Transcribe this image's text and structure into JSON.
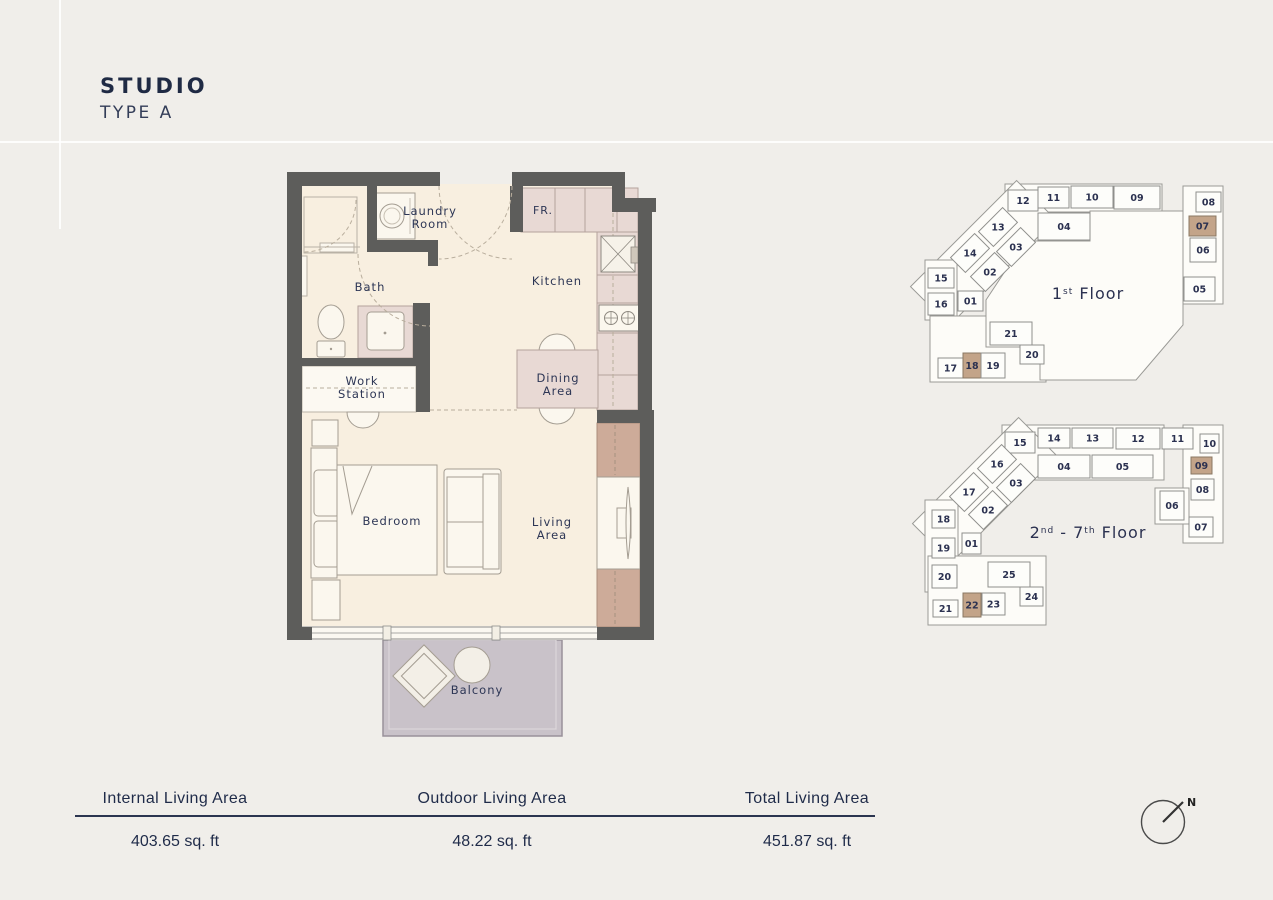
{
  "title": {
    "line1": "STUDIO",
    "line2": "TYPE A"
  },
  "floorplan": {
    "rooms": {
      "laundry": [
        "Laundry",
        "Room"
      ],
      "bath": "Bath",
      "kitchen": "Kitchen",
      "fridge": "FR.",
      "workstation": [
        "Work",
        "Station"
      ],
      "dining": [
        "Dining",
        "Area"
      ],
      "bedroom": "Bedroom",
      "living": [
        "Living",
        "Area"
      ],
      "balcony": "Balcony"
    },
    "colors": {
      "wall": "#5d5d5b",
      "floor": "#f8efe0",
      "counter": "#e8d9d4",
      "wardrobe": "#cdab99",
      "balcony": "#c9c2c9",
      "label": "#2d3655",
      "highlight": "#c3a489"
    }
  },
  "keyplans": [
    {
      "name": "keyplan-first-floor",
      "label_parts": [
        {
          "t": "1"
        },
        {
          "t": "st",
          "sup": true
        },
        {
          "t": " Floor"
        }
      ],
      "label_x": 1088,
      "label_y": 299,
      "blocks": [
        {
          "x": 1005,
          "y": 184,
          "w": 157,
          "h": 28
        },
        {
          "x": 1183,
          "y": 186,
          "w": 40,
          "h": 118
        },
        {
          "x": 908,
          "y": 225.5,
          "w": 150,
          "h": 55,
          "r": -45
        },
        {
          "x": 925,
          "y": 260,
          "w": 32,
          "h": 60
        },
        {
          "x": 930,
          "y": 316,
          "w": 116,
          "h": 66
        }
      ],
      "hall": "1025,241 1090,241 1090,211 1183,211 1183,325 1136,380 1040,380 1040,347 986,347 986,300",
      "units": [
        {
          "n": "12",
          "x": 1008,
          "y": 190,
          "w": 30,
          "h": 21
        },
        {
          "n": "11",
          "x": 1038,
          "y": 187,
          "w": 31,
          "h": 21
        },
        {
          "n": "10",
          "x": 1071,
          "y": 186,
          "w": 42,
          "h": 22
        },
        {
          "n": "09",
          "x": 1114,
          "y": 186,
          "w": 46,
          "h": 23
        },
        {
          "n": "04",
          "x": 1038,
          "y": 213,
          "w": 52,
          "h": 27
        },
        {
          "n": "08",
          "x": 1196,
          "y": 192,
          "w": 25,
          "h": 20
        },
        {
          "n": "07",
          "x": 1189,
          "y": 216,
          "w": 27,
          "h": 20,
          "hl": true
        },
        {
          "n": "06",
          "x": 1190,
          "y": 238,
          "w": 26,
          "h": 24
        },
        {
          "n": "05",
          "x": 1184,
          "y": 277,
          "w": 31,
          "h": 24
        },
        {
          "n": "13",
          "x": 981,
          "y": 216.5,
          "w": 34,
          "h": 21,
          "r": -45
        },
        {
          "n": "03",
          "x": 999,
          "y": 236.5,
          "w": 34,
          "h": 21,
          "r": -45
        },
        {
          "n": "14",
          "x": 953,
          "y": 242.5,
          "w": 34,
          "h": 21,
          "r": -45
        },
        {
          "n": "02",
          "x": 973,
          "y": 261.5,
          "w": 34,
          "h": 21,
          "r": -45
        },
        {
          "n": "15",
          "x": 928,
          "y": 268,
          "w": 26,
          "h": 20
        },
        {
          "n": "16",
          "x": 928,
          "y": 293,
          "w": 26,
          "h": 22
        },
        {
          "n": "01",
          "x": 958,
          "y": 291,
          "w": 25,
          "h": 20
        },
        {
          "n": "21",
          "x": 990,
          "y": 322,
          "w": 42,
          "h": 23
        },
        {
          "n": "20",
          "x": 1020,
          "y": 345,
          "w": 24,
          "h": 19
        },
        {
          "n": "17",
          "x": 938,
          "y": 358,
          "w": 25,
          "h": 20
        },
        {
          "n": "18",
          "x": 963,
          "y": 353,
          "w": 18,
          "h": 25,
          "hl": true
        },
        {
          "n": "19",
          "x": 981,
          "y": 353,
          "w": 24,
          "h": 25
        }
      ]
    },
    {
      "name": "keyplan-upper-floor",
      "label_parts": [
        {
          "t": "2"
        },
        {
          "t": "nd",
          "sup": true
        },
        {
          "t": " - 7"
        },
        {
          "t": "th",
          "sup": true
        },
        {
          "t": " Floor"
        }
      ],
      "label_x": 1088,
      "label_y": 538,
      "blocks": [
        {
          "x": 1002,
          "y": 425,
          "w": 162,
          "h": 55
        },
        {
          "x": 1183,
          "y": 425,
          "w": 40,
          "h": 118
        },
        {
          "x": 1155,
          "y": 488,
          "w": 34,
          "h": 36
        },
        {
          "x": 910,
          "y": 462.5,
          "w": 150,
          "h": 55,
          "r": -45
        },
        {
          "x": 925,
          "y": 500,
          "w": 33,
          "h": 92
        },
        {
          "x": 928,
          "y": 556,
          "w": 118,
          "h": 69
        }
      ],
      "units": [
        {
          "n": "15",
          "x": 1005,
          "y": 432,
          "w": 30,
          "h": 21
        },
        {
          "n": "14",
          "x": 1038,
          "y": 428,
          "w": 32,
          "h": 20
        },
        {
          "n": "13",
          "x": 1072,
          "y": 428,
          "w": 41,
          "h": 20
        },
        {
          "n": "12",
          "x": 1116,
          "y": 428,
          "w": 44,
          "h": 21
        },
        {
          "n": "11",
          "x": 1162,
          "y": 428,
          "w": 31,
          "h": 21
        },
        {
          "n": "10",
          "x": 1200,
          "y": 434,
          "w": 19,
          "h": 19
        },
        {
          "n": "04",
          "x": 1038,
          "y": 455,
          "w": 52,
          "h": 23
        },
        {
          "n": "05",
          "x": 1092,
          "y": 455,
          "w": 61,
          "h": 23
        },
        {
          "n": "09",
          "x": 1191,
          "y": 457,
          "w": 21,
          "h": 17,
          "hl": true
        },
        {
          "n": "08",
          "x": 1191,
          "y": 479,
          "w": 23,
          "h": 21
        },
        {
          "n": "06",
          "x": 1160,
          "y": 491,
          "w": 24,
          "h": 29
        },
        {
          "n": "07",
          "x": 1189,
          "y": 517,
          "w": 24,
          "h": 20
        },
        {
          "n": "16",
          "x": 980,
          "y": 453.5,
          "w": 34,
          "h": 21,
          "r": -45
        },
        {
          "n": "03",
          "x": 999,
          "y": 472.5,
          "w": 34,
          "h": 21,
          "r": -45
        },
        {
          "n": "17",
          "x": 952,
          "y": 481.5,
          "w": 34,
          "h": 21,
          "r": -45
        },
        {
          "n": "02",
          "x": 971,
          "y": 499.5,
          "w": 34,
          "h": 21,
          "r": -45
        },
        {
          "n": "18",
          "x": 932,
          "y": 510,
          "w": 23,
          "h": 18
        },
        {
          "n": "19",
          "x": 932,
          "y": 538,
          "w": 23,
          "h": 20
        },
        {
          "n": "01",
          "x": 962,
          "y": 533,
          "w": 19,
          "h": 21
        },
        {
          "n": "20",
          "x": 932,
          "y": 565,
          "w": 25,
          "h": 23
        },
        {
          "n": "25",
          "x": 988,
          "y": 562,
          "w": 42,
          "h": 25
        },
        {
          "n": "24",
          "x": 1020,
          "y": 587,
          "w": 23,
          "h": 19
        },
        {
          "n": "21",
          "x": 933,
          "y": 600,
          "w": 25,
          "h": 17
        },
        {
          "n": "22",
          "x": 963,
          "y": 593,
          "w": 18,
          "h": 24,
          "hl": true
        },
        {
          "n": "23",
          "x": 982,
          "y": 593,
          "w": 23,
          "h": 22
        }
      ]
    }
  ],
  "stats": {
    "columns": [
      {
        "label": "Internal Living Area",
        "value": "403.65 sq. ft"
      },
      {
        "label": "Outdoor Living Area",
        "value": "48.22 sq. ft"
      },
      {
        "label": "Total Living Area",
        "value": "451.87 sq. ft"
      }
    ]
  },
  "compass": {
    "label": "N"
  }
}
